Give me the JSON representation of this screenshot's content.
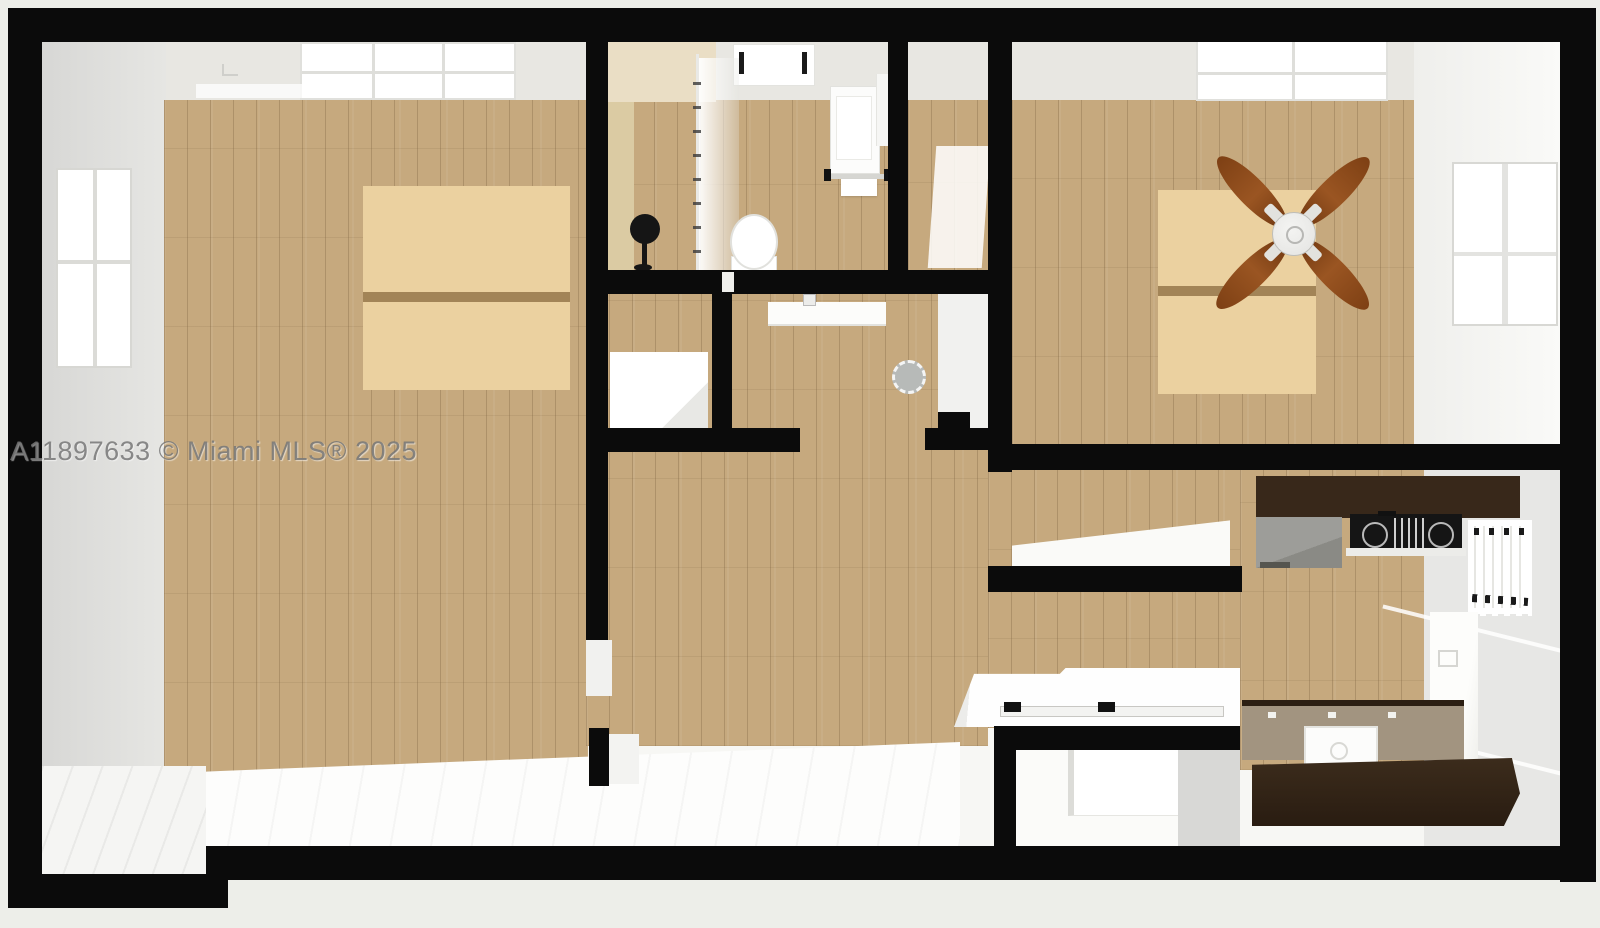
{
  "watermark": {
    "text": "A11897633 © Miami MLS® 2025"
  },
  "scene": {
    "type": "3d-top-down-floor-plan-rendering",
    "rooms": [
      "living-room",
      "bathroom",
      "hall-closet",
      "dressing-room",
      "bedroom",
      "bedroom-closet",
      "kitchen",
      "laundry-nook",
      "entry"
    ],
    "fixtures": [
      "ceiling-fan",
      "shower-curtain-rod",
      "toilet",
      "bathroom-vanity",
      "towel-rack",
      "bathroom-skylight",
      "living-skylight",
      "bedroom-skylight",
      "left-window",
      "bedroom-window",
      "kitchen-window",
      "kitchen-door",
      "sink-counter",
      "round-stool",
      "storage-box",
      "cooktop",
      "dishwasher",
      "kitchen-sink",
      "kitchen-island",
      "kitchen-back-counter",
      "washer",
      "laundry-counter",
      "floor-lamp"
    ]
  },
  "theme": {
    "colors": {
      "bg": "#edeee9",
      "wall": "#0b0b0b",
      "ceiling": "#e8e7e2",
      "wallface": "#d8d8d6",
      "wood": "#c6a97e",
      "patch": "#ebd1a0",
      "patchdiv": "#a28457",
      "tan": "#dbcba3",
      "tanceil": "#eadec5",
      "espresso": "#38281a",
      "cooktop": "#151515",
      "taupe": "#a29480",
      "dw": "#9d9d99",
      "kwall": "#e7e7e5",
      "stool": "#b7bab8",
      "blade": "#9a5522",
      "hub": "#e3e3e1"
    }
  }
}
